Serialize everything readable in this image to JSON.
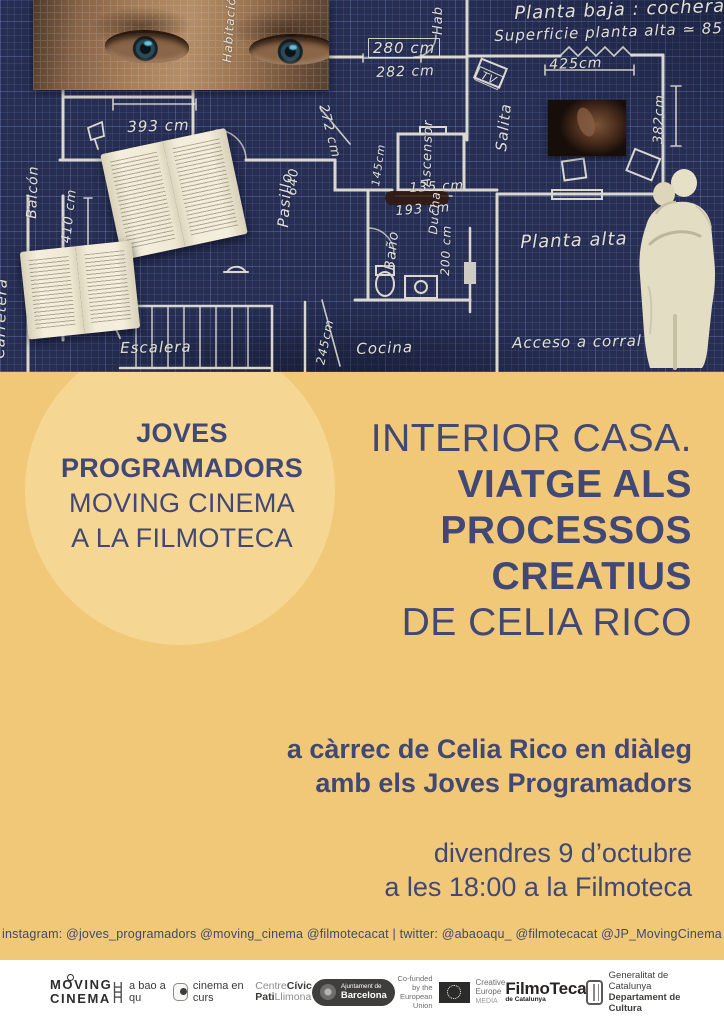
{
  "colors": {
    "yellow": "#f1c877",
    "circle": "#f6d693",
    "navy": "#414875",
    "blueprint_bg": "#272e52",
    "chalk": "#ece9dc"
  },
  "blueprint": {
    "labels": [
      {
        "t": "Planta baja : cochera.",
        "x": 514,
        "y": 3,
        "r": -2,
        "s": 18
      },
      {
        "t": "Superficie planta alta ≃ 85 m²",
        "x": 494,
        "y": 27,
        "r": -2,
        "s": 15
      },
      {
        "t": "280 cm",
        "x": 368,
        "y": 38,
        "r": 0,
        "s": 15,
        "box": true
      },
      {
        "t": "282 cm",
        "x": 376,
        "y": 65,
        "r": -2,
        "s": 14
      },
      {
        "t": "425cm",
        "x": 549,
        "y": 57,
        "r": -2,
        "s": 14
      },
      {
        "t": "TV",
        "x": 480,
        "y": 66,
        "r": 24,
        "s": 11,
        "box": true
      },
      {
        "t": "Hab",
        "x": 446,
        "y": 36,
        "r": -90,
        "s": 13
      },
      {
        "t": "Habitación",
        "x": 234,
        "y": 64,
        "r": -86,
        "s": 12
      },
      {
        "t": "393 cm",
        "x": 127,
        "y": 118,
        "r": -2,
        "s": 15
      },
      {
        "t": "Balcón",
        "x": 40,
        "y": 220,
        "r": -88,
        "s": 14
      },
      {
        "t": "410 cm",
        "x": 74,
        "y": 245,
        "r": -84,
        "s": 13
      },
      {
        "t": "272 cm",
        "x": 330,
        "y": 103,
        "r": 76,
        "s": 13
      },
      {
        "t": "640",
        "x": 300,
        "y": 197,
        "r": -86,
        "s": 13
      },
      {
        "t": "Pasillo",
        "x": 292,
        "y": 229,
        "r": -86,
        "s": 15
      },
      {
        "t": "145cm",
        "x": 382,
        "y": 188,
        "r": -82,
        "s": 11
      },
      {
        "t": "Ascensor",
        "x": 434,
        "y": 188,
        "r": -88,
        "s": 13
      },
      {
        "t": "135 cm",
        "x": 409,
        "y": 181,
        "r": -3,
        "s": 13
      },
      {
        "t": "193 cm",
        "x": 395,
        "y": 204,
        "r": -4,
        "s": 13
      },
      {
        "t": "Ducha",
        "x": 440,
        "y": 236,
        "r": -86,
        "s": 12
      },
      {
        "t": "200 cm",
        "x": 452,
        "y": 277,
        "r": -88,
        "s": 12
      },
      {
        "t": "Baño",
        "x": 398,
        "y": 272,
        "r": -84,
        "s": 14
      },
      {
        "t": "Salita",
        "x": 510,
        "y": 153,
        "r": -84,
        "s": 15
      },
      {
        "t": "382cm",
        "x": 666,
        "y": 145,
        "r": -88,
        "s": 13
      },
      {
        "t": "Planta alta",
        "x": 520,
        "y": 232,
        "r": -2,
        "s": 18
      },
      {
        "t": "Cocina",
        "x": 356,
        "y": 340,
        "r": -2,
        "s": 15
      },
      {
        "t": "245cm",
        "x": 327,
        "y": 367,
        "r": -78,
        "s": 12
      },
      {
        "t": "Acceso a corral",
        "x": 512,
        "y": 334,
        "r": -1,
        "s": 15
      },
      {
        "t": "Carretera",
        "x": 8,
        "y": 360,
        "r": -88,
        "s": 15
      },
      {
        "t": "Escalera",
        "x": 120,
        "y": 339,
        "r": -1,
        "s": 15
      }
    ]
  },
  "event": {
    "left_title": {
      "l1": "JOVES",
      "l2": "PROGRAMADORS",
      "l3": "MOVING CINEMA",
      "l4": "A LA FILMOTECA"
    },
    "main_title": {
      "l1": "INTERIOR CASA.",
      "l2": "VIATGE ALS",
      "l3": "PROCESSOS",
      "l4": "CREATIUS",
      "l5": "DE CELIA RICO"
    },
    "subtitle": {
      "l1": "a càrrec de Celia Rico en diàleg",
      "l2": "amb els Joves Programadors"
    },
    "datetime": {
      "l1": "divendres 9 d’octubre",
      "l2": "a les 18:00 a la Filmoteca"
    },
    "social": "instagram: @joves_programadors @moving_cinema @filmotecacat  | twitter: @abaoaqu_ @filmotecacat @JP_MovingCinema"
  },
  "footer": {
    "moving_cinema": {
      "l1": "MOVING",
      "l2": "CINEMA"
    },
    "abaoaqu": "a bao a qu",
    "cinema_en_curs": "cinema en curs",
    "centre_civic": {
      "a": "Centre",
      "b": "Cívic",
      "c": "Pati",
      "d": "Llimona"
    },
    "ajuntament": {
      "l1": "Ajuntament de",
      "l2": "Barcelona"
    },
    "eu": {
      "l1": "Co-funded by the",
      "l2": "European Union",
      "c1": "Creative",
      "c2": "Europe",
      "c3": "MEDIA"
    },
    "filmoteca": {
      "name": "FilmoTeca",
      "sub": "de Catalunya"
    },
    "generalitat": {
      "l1": "Generalitat de Catalunya",
      "l2": "Departament de Cultura"
    }
  }
}
